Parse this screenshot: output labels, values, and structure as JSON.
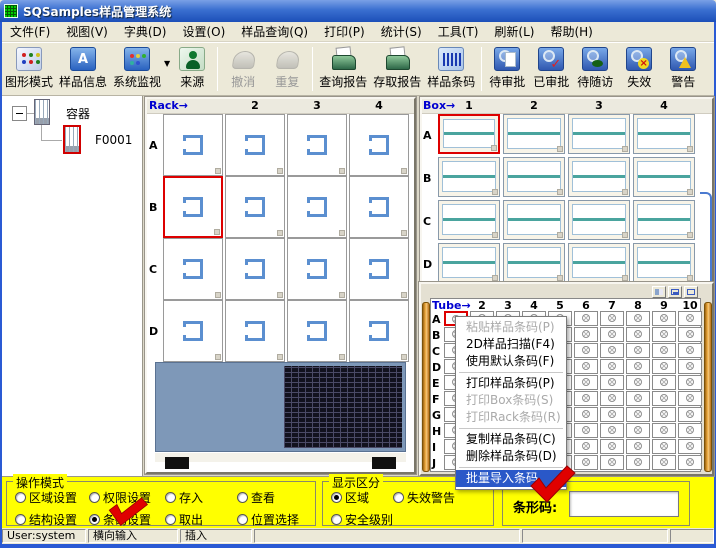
{
  "window": {
    "title": "SQSamples样品管理系统"
  },
  "menubar": {
    "items": [
      "文件(F)",
      "视图(V)",
      "字典(D)",
      "设置(O)",
      "样品查询(Q)",
      "打印(P)",
      "统计(S)",
      "工具(T)",
      "刷新(L)",
      "帮助(H)"
    ]
  },
  "toolbar": {
    "groups": [
      {
        "buttons": [
          {
            "label": "图形模式",
            "icon": "dots-grid-icon"
          },
          {
            "label": "样品信息",
            "icon": "sample-info-icon"
          },
          {
            "label": "系统监视",
            "icon": "monitor-icon",
            "dropdown": true
          },
          {
            "label": "来源",
            "icon": "person-icon"
          }
        ]
      },
      {
        "buttons": [
          {
            "label": "撤消",
            "icon": "undo-icon",
            "disabled": true
          },
          {
            "label": "重复",
            "icon": "redo-icon",
            "disabled": true
          }
        ]
      },
      {
        "buttons": [
          {
            "label": "查询报告",
            "icon": "printer-icon"
          },
          {
            "label": "存取报告",
            "icon": "printer-icon"
          },
          {
            "label": "样品条码",
            "icon": "barcode-icon"
          }
        ]
      },
      {
        "buttons": [
          {
            "label": "待审批",
            "icon": "search-doc-icon"
          },
          {
            "label": "已审批",
            "icon": "search-check-icon"
          },
          {
            "label": "待随访",
            "icon": "search-follow-icon"
          },
          {
            "label": "失效",
            "icon": "search-invalid-icon"
          },
          {
            "label": "警告",
            "icon": "search-warning-icon"
          },
          {
            "label": "预警",
            "icon": "search-warning-icon"
          }
        ]
      }
    ]
  },
  "tree": {
    "root_label": "容器",
    "child_label": "F0001"
  },
  "rack": {
    "title": "Rack→",
    "col_headers": [
      "2",
      "3",
      "4"
    ],
    "rows": [
      "A",
      "B",
      "C",
      "D"
    ],
    "cols": 4,
    "selected": "B1"
  },
  "box": {
    "title": "Box→",
    "col_headers": [
      "1",
      "2",
      "3",
      "4"
    ],
    "rows": [
      "A",
      "B",
      "C",
      "D"
    ],
    "cols": 4,
    "selected": "A1"
  },
  "tube": {
    "title": "Tube→",
    "col_headers": [
      "2",
      "3",
      "4",
      "5",
      "6",
      "7",
      "8",
      "9",
      "10"
    ],
    "rows": [
      "A",
      "B",
      "C",
      "D",
      "E",
      "F",
      "G",
      "H",
      "I",
      "J"
    ],
    "cols": 10,
    "selected": "A1"
  },
  "context_menu": {
    "items": [
      {
        "label": "粘贴样品条码(P)",
        "state": "disabled"
      },
      {
        "label": "2D样品扫描(F4)",
        "state": "normal"
      },
      {
        "label": "使用默认条码(F)",
        "state": "normal"
      },
      {
        "type": "separator"
      },
      {
        "label": "打印样品条码(P)",
        "state": "normal"
      },
      {
        "label": "打印Box条码(S)",
        "state": "disabled"
      },
      {
        "label": "打印Rack条码(R)",
        "state": "disabled"
      },
      {
        "type": "separator"
      },
      {
        "label": "复制样品条码(C)",
        "state": "normal"
      },
      {
        "label": "删除样品条码(D)",
        "state": "normal"
      },
      {
        "type": "separator"
      },
      {
        "label": "批量导入条码",
        "state": "highlighted"
      }
    ]
  },
  "operation_mode": {
    "title": "操作模式",
    "rows": [
      [
        {
          "label": "区域设置",
          "checked": false
        },
        {
          "label": "权限设置",
          "checked": false
        },
        {
          "label": "存入",
          "checked": false
        },
        {
          "label": "查看",
          "checked": false
        }
      ],
      [
        {
          "label": "结构设置",
          "checked": false
        },
        {
          "label": "条码设置",
          "checked": true
        },
        {
          "label": "取出",
          "checked": false
        },
        {
          "label": "位置选择",
          "checked": false
        }
      ]
    ]
  },
  "display_mode": {
    "title": "显示区分",
    "rows": [
      [
        {
          "label": "区域",
          "checked": true
        },
        {
          "label": "失效警告",
          "checked": false
        }
      ],
      [
        {
          "label": "安全级别",
          "checked": false
        }
      ]
    ]
  },
  "barcode_panel": {
    "label": "条形码:",
    "value": ""
  },
  "statusbar": {
    "panels": [
      "User:system",
      "横向输入",
      "插入",
      "",
      "",
      ""
    ]
  },
  "colors": {
    "selection_red": "#dd0000",
    "menu_highlight": "#2a58c8",
    "panel_yellow": "#ffff00",
    "grid_title_blue": "#0000d0"
  }
}
